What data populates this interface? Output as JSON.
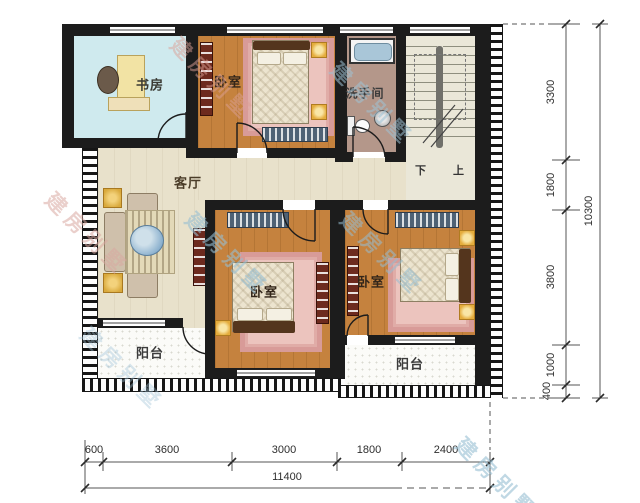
{
  "rooms": {
    "study": {
      "label": "书房"
    },
    "bedroom_top": {
      "label": "卧室"
    },
    "bathroom": {
      "label": "洗手间"
    },
    "living_room": {
      "label": "客厅"
    },
    "bedroom_middle": {
      "label": "卧室"
    },
    "bedroom_right": {
      "label": "卧室"
    },
    "balcony_left": {
      "label": "阳台"
    },
    "balcony_right": {
      "label": "阳台"
    }
  },
  "stairs": {
    "down": "下",
    "up": "上"
  },
  "dimensions": {
    "right": {
      "segments": [
        "3300",
        "1800",
        "3800",
        "1000",
        "400"
      ],
      "total": "10300"
    },
    "bottom": {
      "segments": [
        "600",
        "3600",
        "3000",
        "1800",
        "2400"
      ],
      "total": "11400"
    }
  },
  "watermark": {
    "text": "建房别墅"
  },
  "colors": {
    "wall": "#1c1c1c",
    "wood_floor": "#c5823e",
    "living_floor": "#e8e1cb",
    "study_floor": "#cfeaee",
    "bath_floor": "#b4978a",
    "rug_pink": "#d89b98",
    "lamp_accent": "#e5ad3d",
    "watermark_blue": "#9fc3d6",
    "watermark_pink": "#d8a8a0"
  }
}
